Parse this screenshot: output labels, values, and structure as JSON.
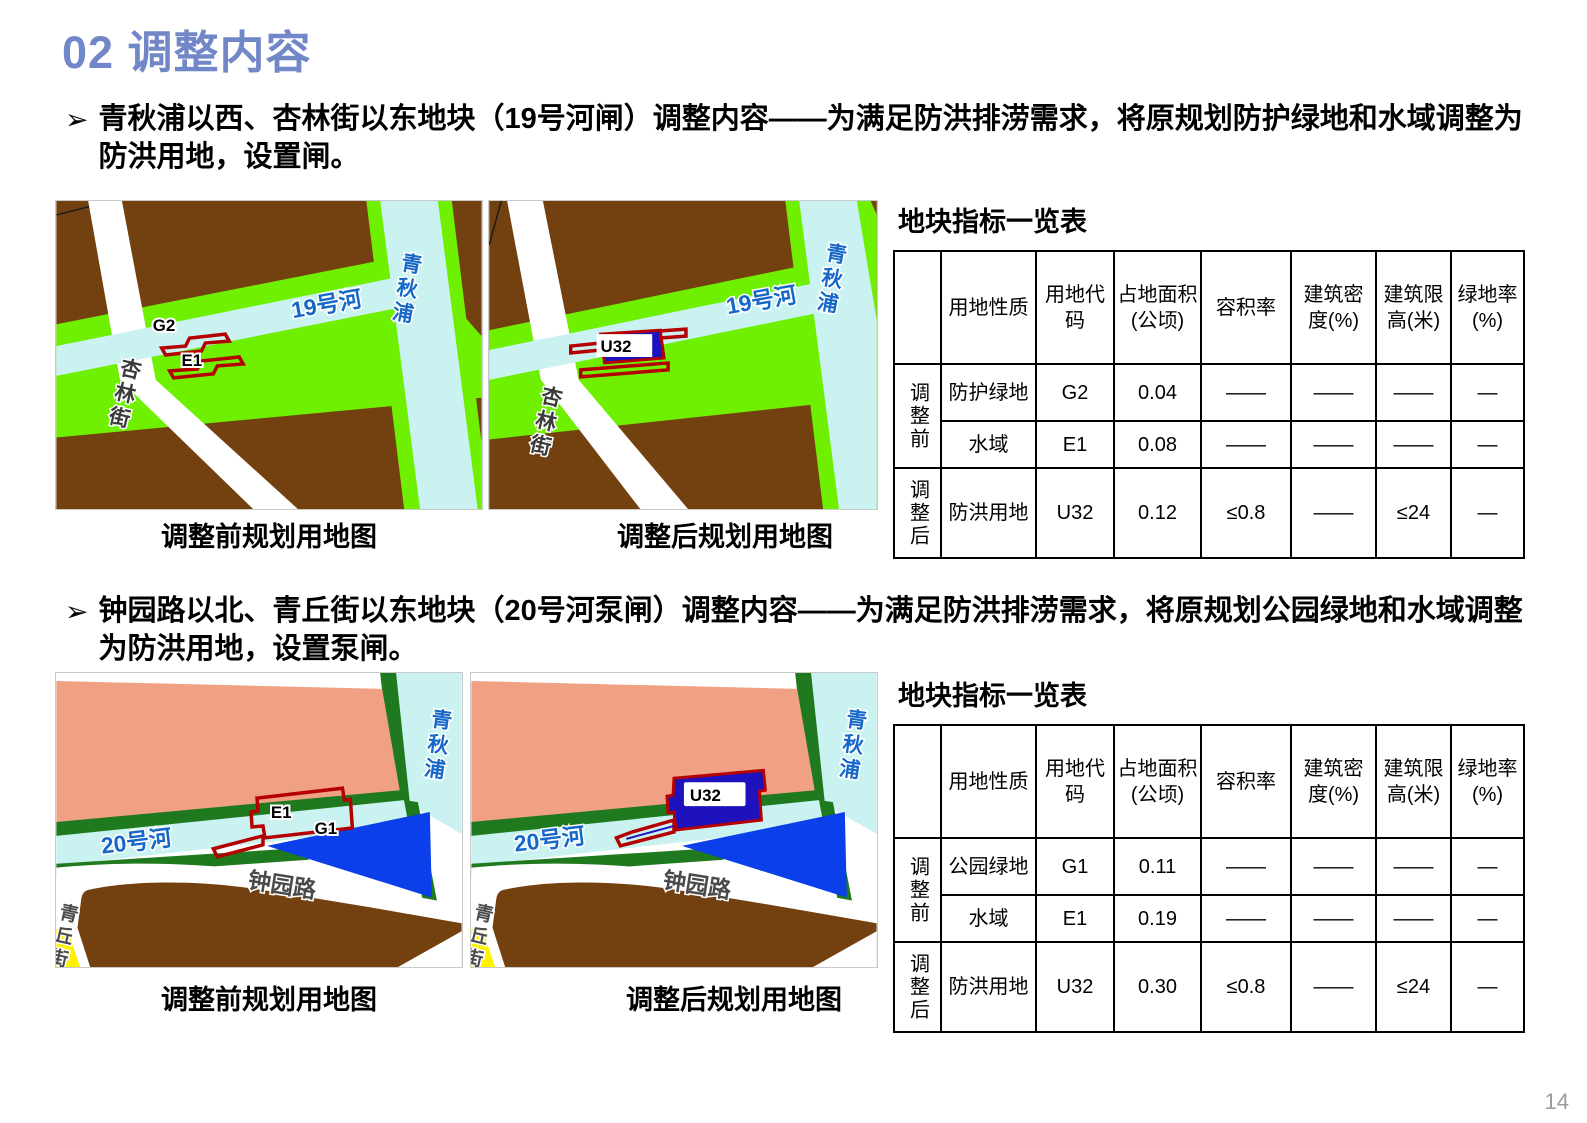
{
  "slide": {
    "title": "02 调整内容",
    "page_number": "14"
  },
  "colors": {
    "title_blue": "#7287C8",
    "map_brown": "#73400F",
    "map_bright_green": "#6EF000",
    "map_water_cyan": "#C9F2F0",
    "map_park_salmon": "#F1A183",
    "map_dark_green": "#1F7A1F",
    "map_parcel_blue": "#0A3FEA",
    "map_flood_blue": "#1D12BE",
    "parcel_outline_red": "#B40000",
    "map_road_yellow": "#FFF200",
    "river_label_blue": "#1668C8",
    "page_number_gray": "#9B9B9B"
  },
  "section19": {
    "bullet_marker": "➢",
    "bullet": "青秋浦以西、杏林街以东地块（19号河闸）调整内容——为满足防洪排涝需求，将原规划防护绿地和水域调整为防洪用地，设置闸。",
    "caption_before": "调整前规划用地图",
    "caption_after": "调整后规划用地图",
    "table_title": "地块指标一览表",
    "map_labels": {
      "river_vertical": "青秋浦",
      "river_horizontal": "19号河",
      "street": "杏林街",
      "parcel_g2": "G2",
      "parcel_e1": "E1",
      "parcel_u32": "U32"
    },
    "table": {
      "header": [
        "用地性质",
        "用地代码",
        "占地面积(公顷)",
        "容积率",
        "建筑密度(%)",
        "建筑限高(米)",
        "绿地率(%)"
      ],
      "groups": [
        "调整前",
        "调整后"
      ],
      "rows": [
        [
          "防护绿地",
          "G2",
          "0.04",
          "——",
          "——",
          "——",
          "—"
        ],
        [
          "水域",
          "E1",
          "0.08",
          "——",
          "——",
          "——",
          "—"
        ],
        [
          "防洪用地",
          "U32",
          "0.12",
          "≤0.8",
          "——",
          "≤24",
          "—"
        ]
      ]
    }
  },
  "section20": {
    "bullet_marker": "➢",
    "bullet": "钟园路以北、青丘街以东地块（20号河泵闸）调整内容——为满足防洪排涝需求，将原规划公园绿地和水域调整为防洪用地，设置泵闸。",
    "caption_before": "调整前规划用地图",
    "caption_after": "调整后规划用地图",
    "table_title": "地块指标一览表",
    "map_labels": {
      "river_vertical": "青秋浦",
      "river_horizontal": "20号河",
      "street_bottom": "钟园路",
      "street_left": "青丘街",
      "parcel_e1": "E1",
      "parcel_g1": "G1",
      "parcel_u32": "U32"
    },
    "table": {
      "header": [
        "用地性质",
        "用地代码",
        "占地面积(公顷)",
        "容积率",
        "建筑密度(%)",
        "建筑限高(米)",
        "绿地率(%)"
      ],
      "groups": [
        "调整前",
        "调整后"
      ],
      "rows": [
        [
          "公园绿地",
          "G1",
          "0.11",
          "——",
          "——",
          "——",
          "—"
        ],
        [
          "水域",
          "E1",
          "0.19",
          "——",
          "——",
          "——",
          "—"
        ],
        [
          "防洪用地",
          "U32",
          "0.30",
          "≤0.8",
          "——",
          "≤24",
          "—"
        ]
      ]
    }
  }
}
